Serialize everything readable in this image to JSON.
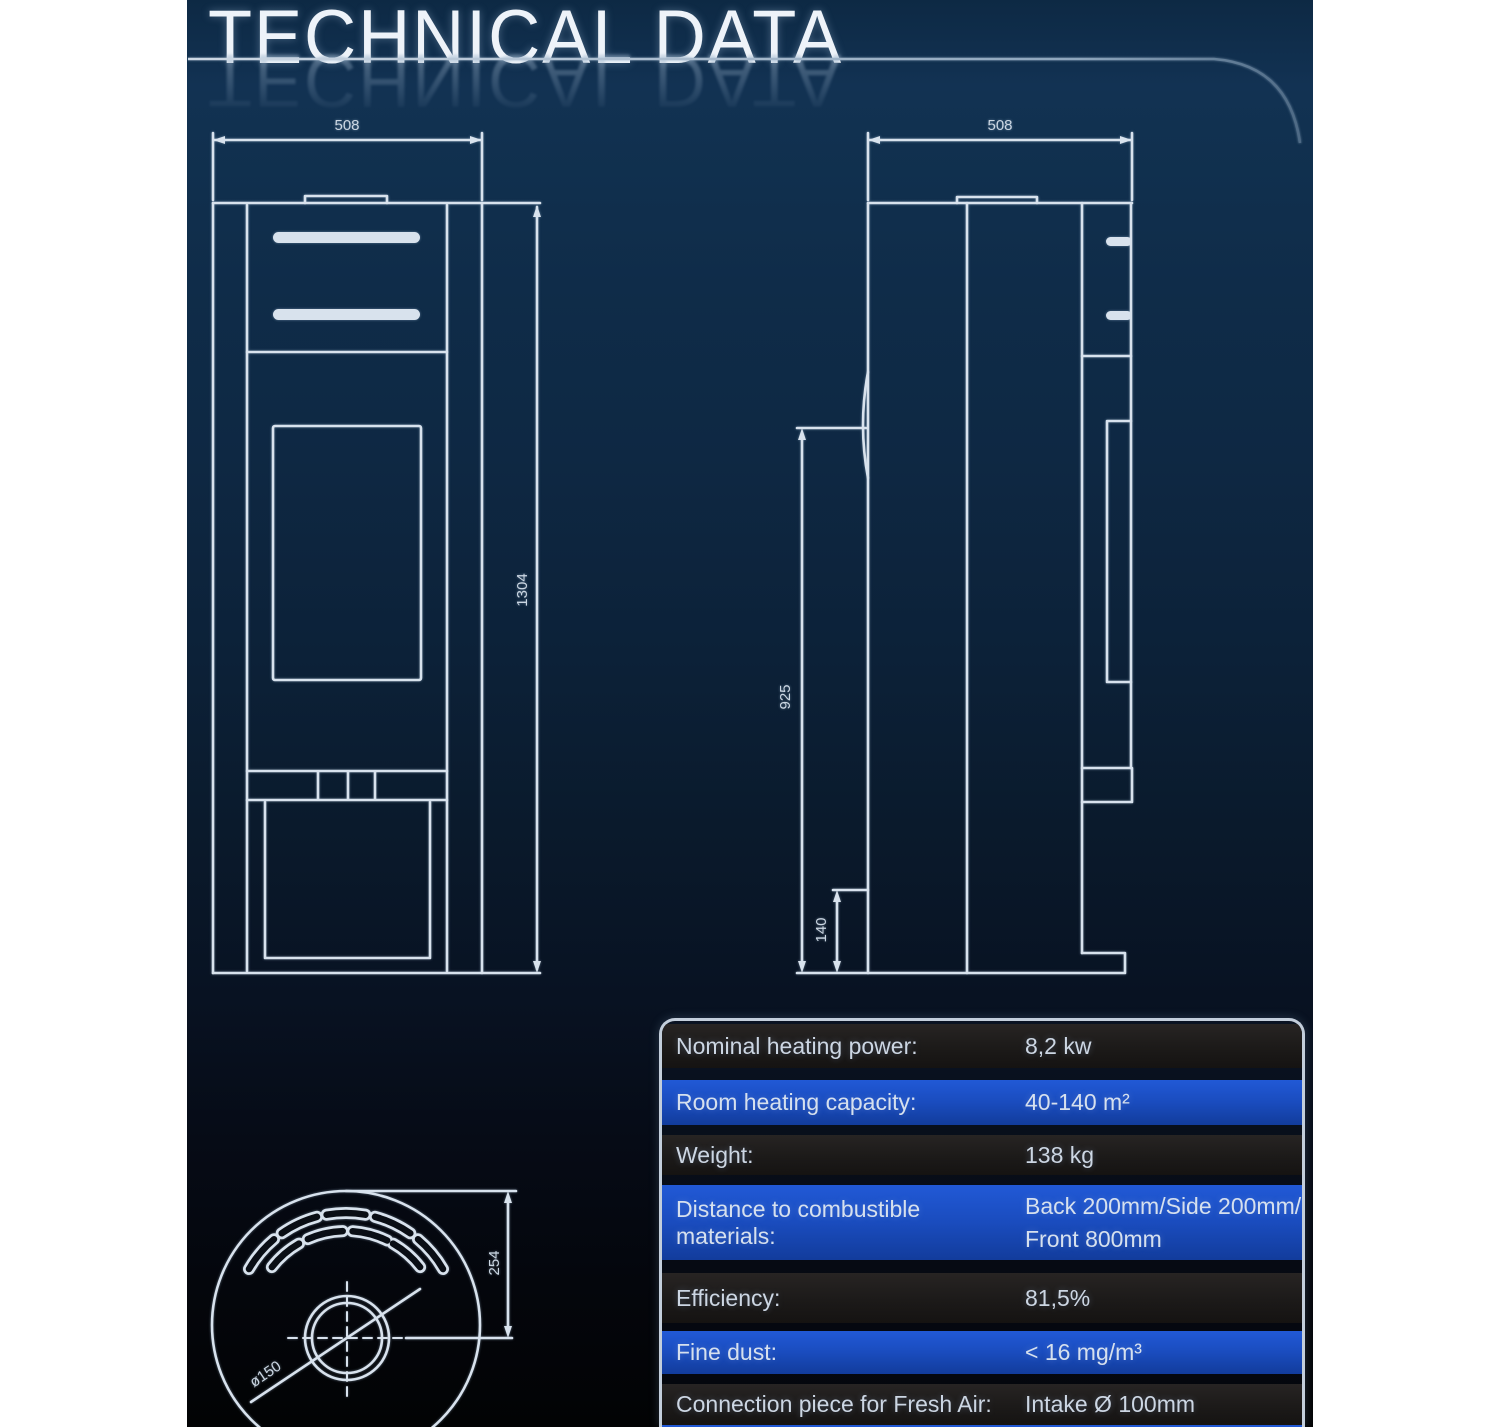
{
  "page": {
    "title": "TECHNICAL DATA"
  },
  "colors": {
    "background_top": "#0d2944",
    "background_bottom": "#020304",
    "line": "#d8e2ed",
    "table_blue_row": "#1a4cbe",
    "table_dark_row": "#1c1a19",
    "table_border": "#c3cedb"
  },
  "drawings": {
    "front_view": {
      "width_label": "508",
      "height_label": "1304"
    },
    "side_view": {
      "depth_label": "508",
      "upper_height_label": "925",
      "base_height_label": "140"
    },
    "top_view": {
      "flue_offset_label": "254",
      "flue_diameter_label": "ø150"
    }
  },
  "table": {
    "rows": [
      {
        "label": "Nominal heating power:",
        "value": "8,2 kw"
      },
      {
        "label": "Room heating capacity:",
        "value": "40-140 m²"
      },
      {
        "label": "Weight:",
        "value": "138 kg"
      },
      {
        "label": "Distance to combustible materials:",
        "value": "Back 200mm/Side 200mm/",
        "value2": "Front 800mm"
      },
      {
        "label": "Efficiency:",
        "value": "81,5%"
      },
      {
        "label": "Fine dust:",
        "value": "< 16 mg/m³"
      },
      {
        "label": "Connection piece for Fresh Air:",
        "value": "Intake Ø 100mm"
      }
    ]
  }
}
